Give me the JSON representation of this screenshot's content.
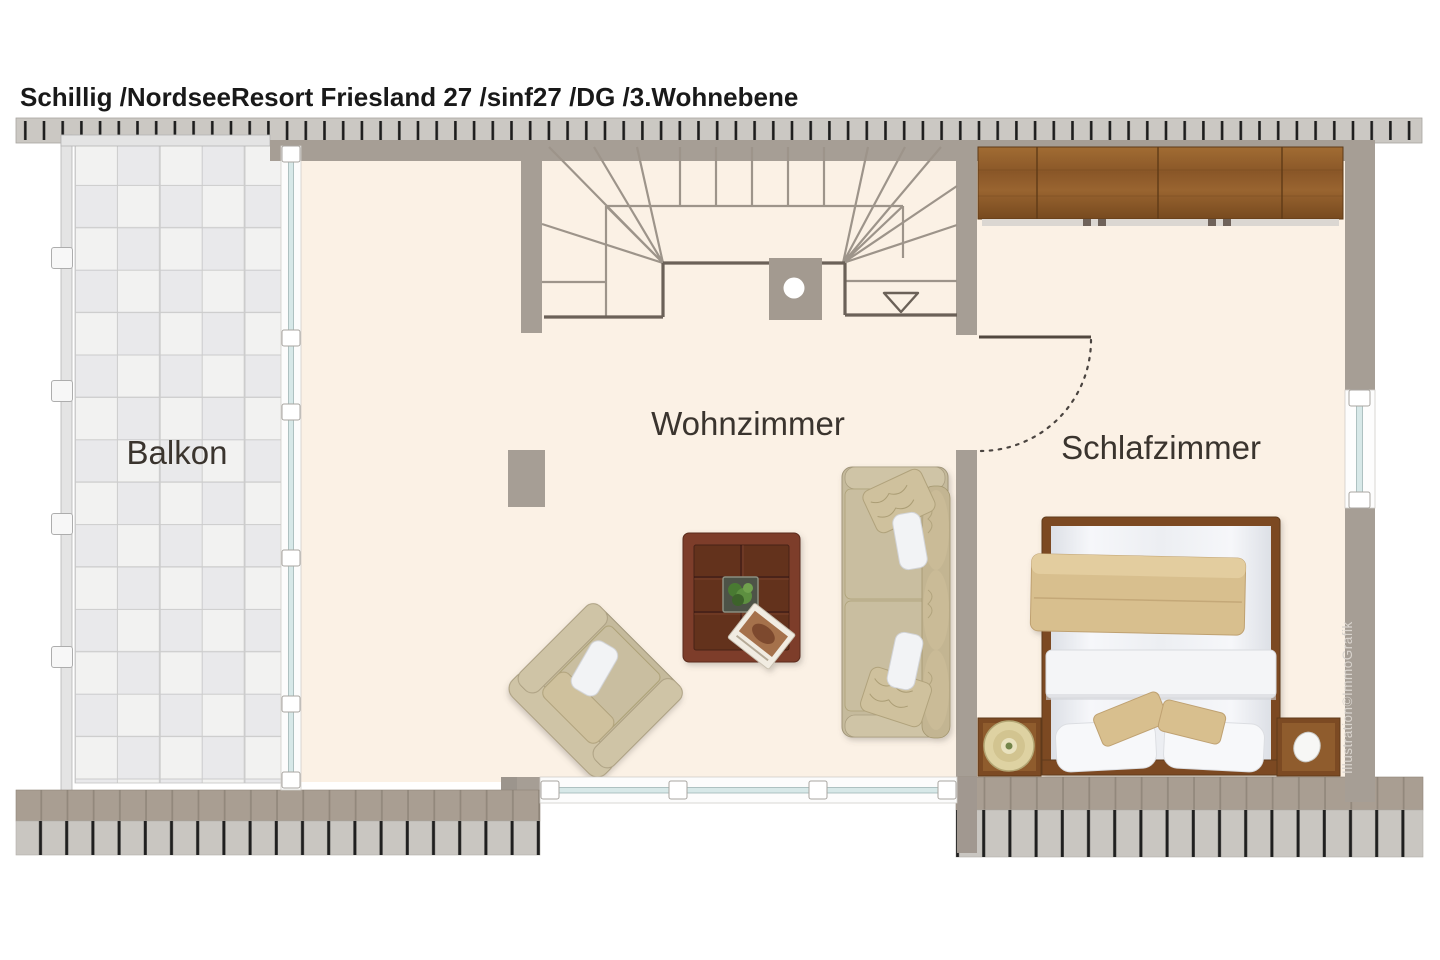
{
  "title": "Schillig /NordseeResort Friesland 27 /sinf27 /DG /3.Wohnebene",
  "credit": "Illustration©ImmoGrafik",
  "rooms": {
    "balcony": {
      "label": "Balkon"
    },
    "living_room": {
      "label": "Wohnzimmer"
    },
    "bedroom": {
      "label": "Schlafzimmer"
    }
  },
  "stairs": {
    "direction_marker": "down-arrow"
  },
  "colors": {
    "floor": "#fbf1e5",
    "wall": "#a69e95",
    "tile_light": "#f2f2f1",
    "tile_dark": "#e9e9eb",
    "wardrobe_wood": "#8a5728",
    "bed_wood": "#7c4a23",
    "table_wood": "#7d3e2a",
    "upholstery": "#c5ba9c",
    "blanket": "#d8bf8e",
    "window_glass": "#d7e8e8",
    "deck_brown": "#a99e92",
    "deck_gray": "#c9c6c1",
    "stair_line": "#9d948a",
    "stair_edge": "#6b6158",
    "title_color": "#191919"
  }
}
